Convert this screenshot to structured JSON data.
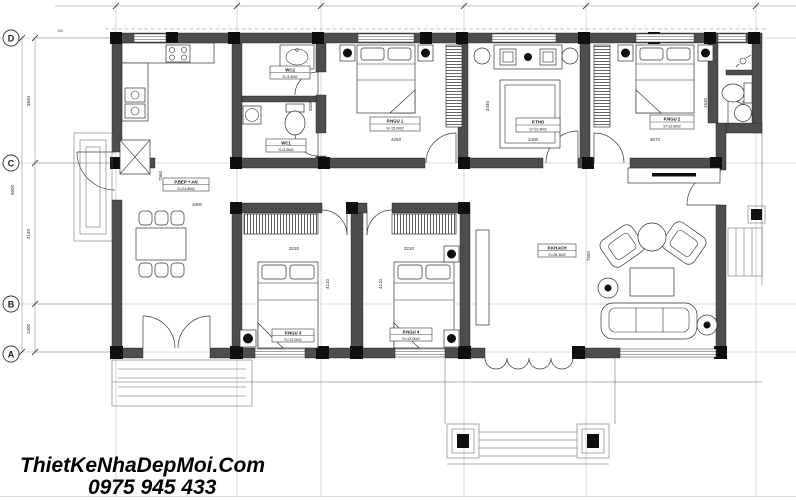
{
  "watermark": {
    "line1": "ThietKeNhaDepMoi.Com",
    "line2": "0975 945 433"
  },
  "grid": {
    "rows": [
      {
        "label": "D"
      },
      {
        "label": "C"
      },
      {
        "label": "B"
      },
      {
        "label": "A"
      }
    ]
  },
  "rooms": {
    "kitchen": {
      "name": "P.BEP + AN",
      "area": "S=24.8M2"
    },
    "wc2": {
      "name": "WC2",
      "area": "S=3.9M2"
    },
    "wc1": {
      "name": "WC1",
      "area": "S=3.9M2"
    },
    "bedroom1": {
      "name": "P.NGU 1",
      "area": "S=15.0M2"
    },
    "altar": {
      "name": "P.THO",
      "area": "S=12.9M2"
    },
    "bedroom2": {
      "name": "P.NGU 2",
      "area": "S=12.6M2"
    },
    "bedroom3": {
      "name": "P.NGU 3",
      "area": "S=13.0M2"
    },
    "bedroom4": {
      "name": "P.NGU 4",
      "area": "S=13.0M2"
    },
    "living": {
      "name": "P.KHACH",
      "area": "S=28.3M2"
    }
  },
  "dimensions": {
    "left_overall": "9500",
    "left_d_c": "3640",
    "left_c_b": "4140",
    "left_b_a": "1300",
    "left_top_offset": "130",
    "kitchen_width": "1900",
    "kitchen_depth": "7560",
    "bed1_width": "4250",
    "bed1_depth": "3500",
    "altar_width": "3400",
    "altar_depth": "3440",
    "bed2_width": "3670",
    "wc3_depth": "1530",
    "bed3_width": "3220",
    "bed4_width": "3220",
    "bed3_depth": "4110",
    "bed4_depth": "4110",
    "living_depth": "7580"
  },
  "colors": {
    "wall": "#4d4d4d",
    "column": "#0f0f0f",
    "line": "#333333",
    "watermark": "#000000"
  }
}
